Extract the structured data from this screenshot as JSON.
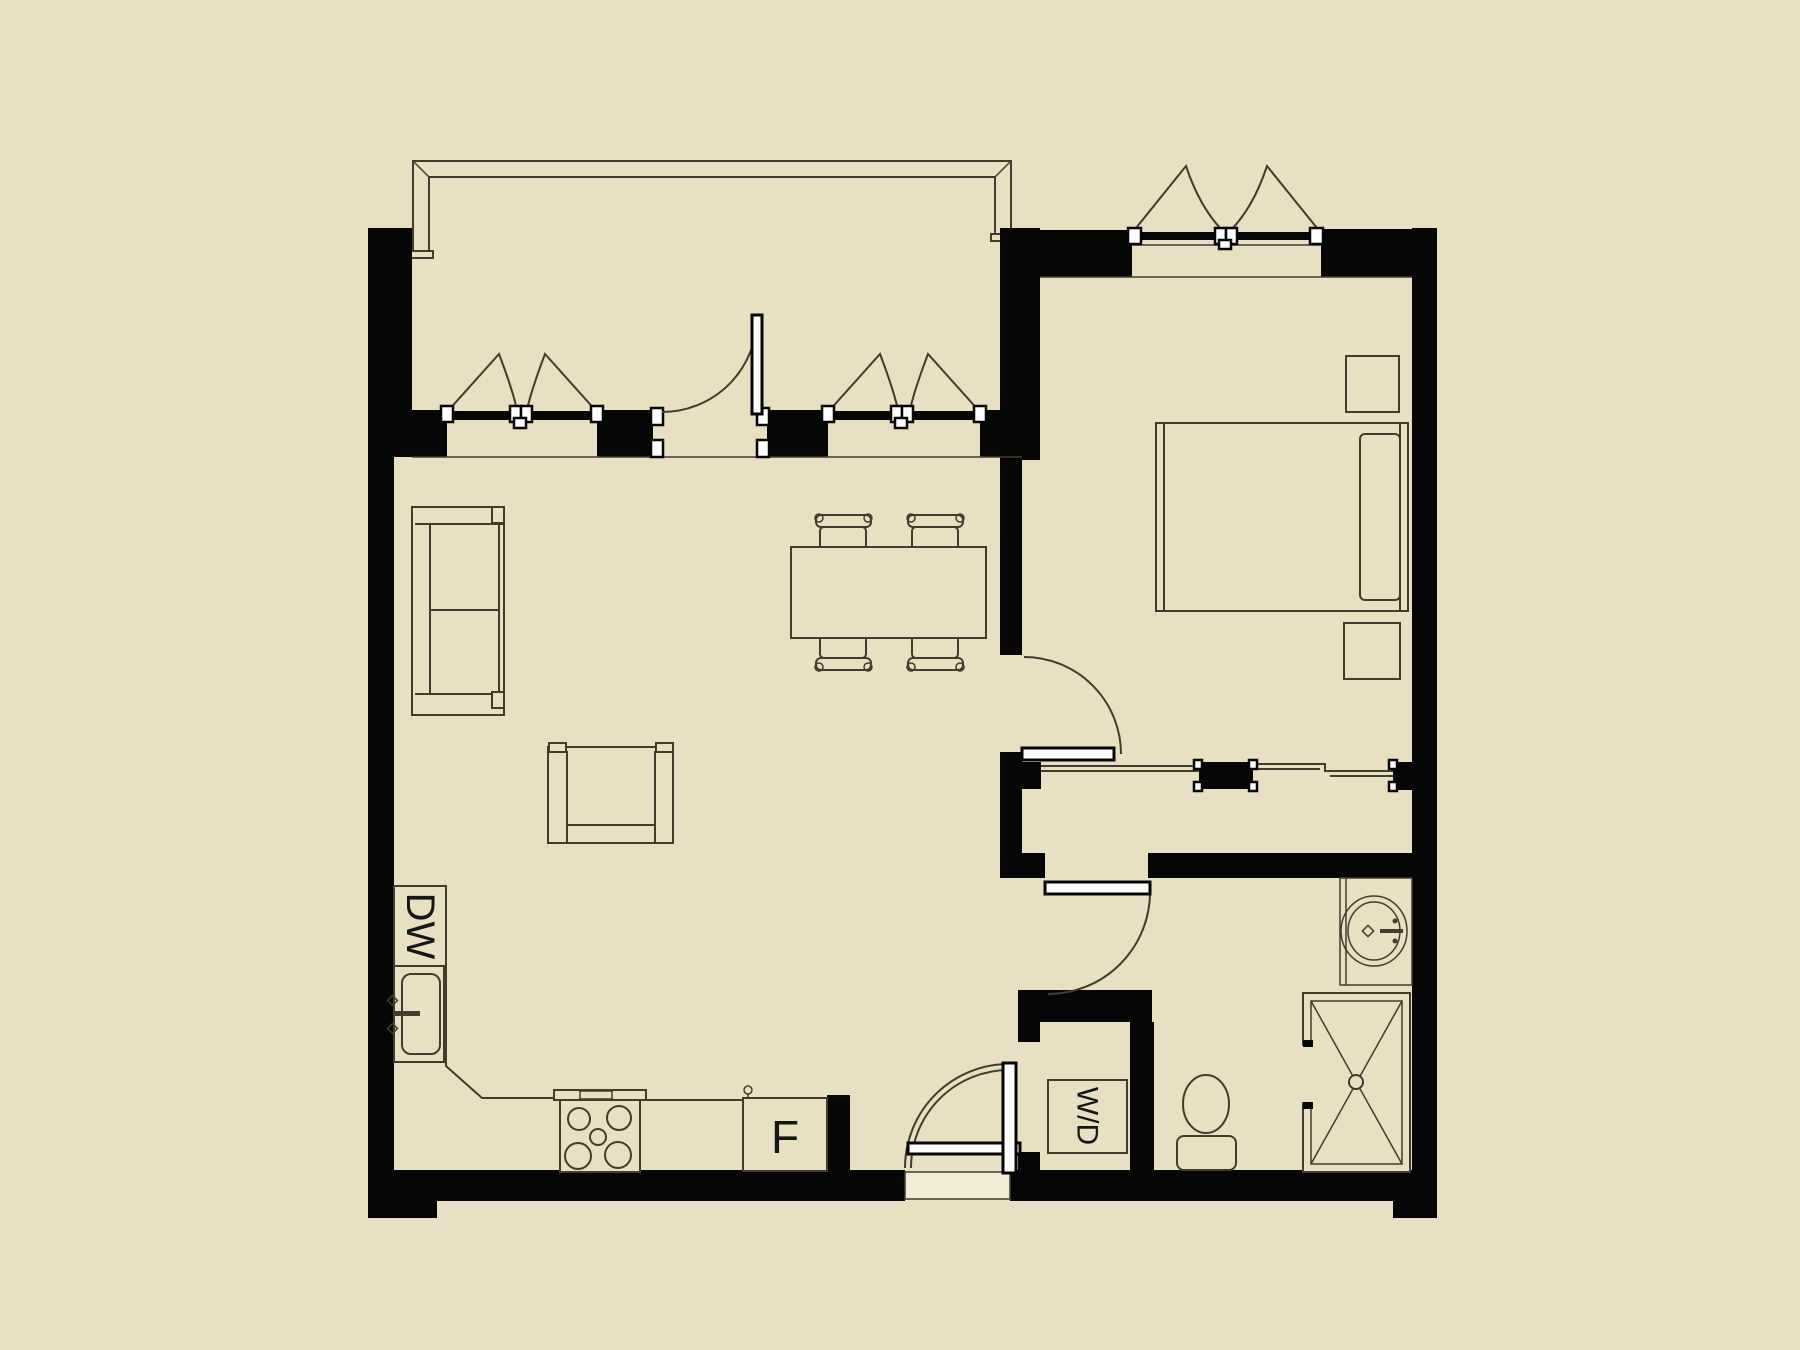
{
  "plan": {
    "type": "apartment-floor-plan",
    "labels": {
      "dishwasher": "DW",
      "fridge": "F",
      "washer_dryer": "W/D"
    }
  },
  "colors": {
    "bg": "#e9dfc3",
    "wall": "#060606",
    "line": "#433b2d"
  }
}
